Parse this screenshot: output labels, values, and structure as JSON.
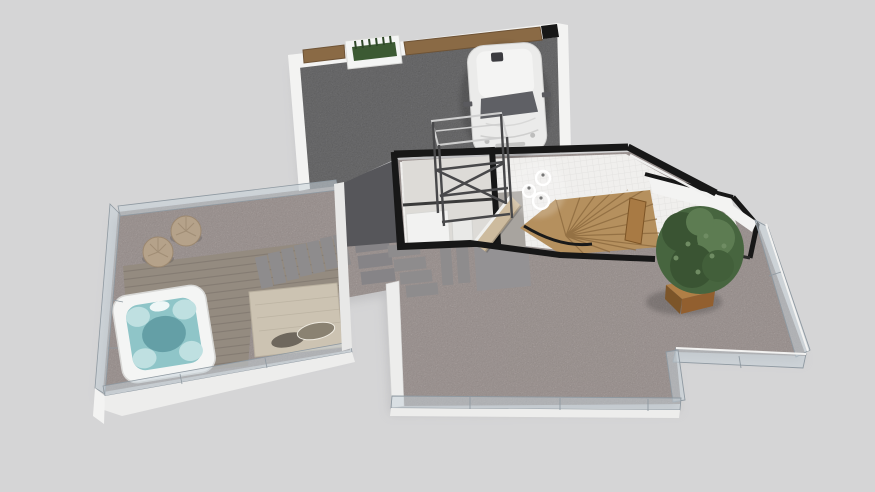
{
  "scene": {
    "title": "3D floor plan render - top axonometric view",
    "view": "axonometric",
    "areas": [
      "driveway",
      "entry-hall",
      "stair-well",
      "utility-room",
      "upper-room",
      "left-terrace",
      "main-terrace"
    ],
    "objects": [
      "car",
      "wood-fence",
      "planter-box",
      "metal-frame",
      "pendant-lights",
      "staircase",
      "wood-ramp",
      "interior-door",
      "potted-tree",
      "glass-railing",
      "hot-tub",
      "wood-deck",
      "lounge-mat",
      "poufs",
      "stepping-stones",
      "concrete-pad"
    ]
  },
  "colors": {
    "background": "#d5d5d6",
    "shadow": "#b2b2b5",
    "asphalt": "#6f6f71",
    "asphaltFace": "#56565a",
    "gravel": "#b1a5a2",
    "stone": "#8e8c8d",
    "pad": "#949294",
    "deck": "#948b80",
    "deckLine": "#7d756b",
    "mat": "#ccc3b2",
    "pillowDark": "#6e675d",
    "pillowLight": "#8a8272",
    "pouf": "#b5a28a",
    "tubShell": "#f4f5f4",
    "tubWater": "#8fc5c8",
    "tubSeat": "#bfe0e1",
    "tubDeep": "#649fa6",
    "wallWhite": "#f3f3f2",
    "wallBlack": "#171717",
    "slabWhite": "#ededec",
    "glass": "#c6d2d9",
    "glassEdge": "#8f99a1",
    "fenceWood": "#8a6a45",
    "plantGreen": "#3c5a33",
    "tile": "#f0efed",
    "concrete": "#a8a49f",
    "roomFloor": "#dddbd7",
    "fixtureWhite": "#f2f2f1",
    "stairWood": "#b5905e",
    "stairLine": "#8a673c",
    "doorWood": "#a87a44",
    "rampWood": "#cdbb9e",
    "treeBase": "#47653f",
    "treeDark": "#3a5433",
    "treeLight": "#5d7c52",
    "planterWood": "#b07f46",
    "planterSideL": "#7c5529",
    "planterSideR": "#925f2f",
    "carBody": "#ebebea",
    "carRoof": "#f4f4f3",
    "carGlass": "#5f6065",
    "metal": "#48484a",
    "metalLight": "#cfcfcf"
  }
}
